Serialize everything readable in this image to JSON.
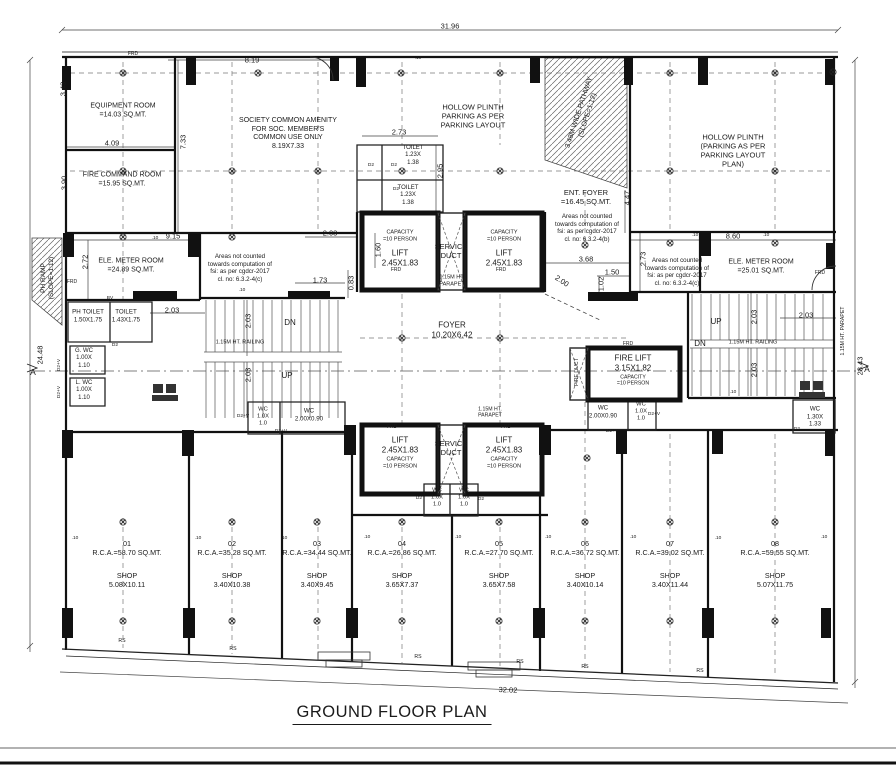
{
  "meta": {
    "ink": "#1a1a1a",
    "paper": "#ffffff"
  },
  "title": {
    "text": "GROUND FLOOR PLAN"
  },
  "annotations": [
    {
      "n": "dim-total-top",
      "t": "31.96",
      "x": 450,
      "y": 26
    },
    {
      "n": "dim-8-19",
      "t": "8.19",
      "x": 252,
      "y": 60
    },
    {
      "n": "dim-3-43",
      "t": "3.43",
      "x": 63,
      "y": 89,
      "r": -90
    },
    {
      "n": "dim-4-09",
      "t": "4.09",
      "x": 112,
      "y": 143
    },
    {
      "n": "dim-7-33",
      "t": "7.33",
      "x": 183,
      "y": 142,
      "r": -90
    },
    {
      "n": "dim-3-90",
      "t": "3.90",
      "x": 64,
      "y": 183,
      "r": -90
    },
    {
      "n": "dim-2-73-toilet",
      "t": "2.73",
      "x": 399,
      "y": 132
    },
    {
      "n": "dim-2-95",
      "t": "2.95",
      "x": 440,
      "y": 171,
      "r": -90
    },
    {
      "n": "dim-9-15",
      "t": "9.15",
      "x": 173,
      "y": 236
    },
    {
      "n": "dim-2-03-top",
      "t": "2.03",
      "x": 330,
      "y": 233
    },
    {
      "n": "dim-8-60",
      "t": "8.60",
      "x": 733,
      "y": 236
    },
    {
      "n": "dim-2-72",
      "t": "2.72",
      "x": 85,
      "y": 262,
      "r": -90
    },
    {
      "n": "dim-2-03-left",
      "t": "2.03",
      "x": 172,
      "y": 310
    },
    {
      "n": "dim-1-60",
      "t": "1.60",
      "x": 378,
      "y": 250,
      "r": -90
    },
    {
      "n": "dim-1-73",
      "t": "1.73",
      "x": 320,
      "y": 280
    },
    {
      "n": "dim-0-83",
      "t": "0.83",
      "x": 351,
      "y": 283,
      "r": -90
    },
    {
      "n": "dim-3-68",
      "t": "3.68",
      "x": 586,
      "y": 259
    },
    {
      "n": "dim-1-50",
      "t": "1.50",
      "x": 612,
      "y": 272
    },
    {
      "n": "dim-1-02",
      "t": "1.02",
      "x": 601,
      "y": 284,
      "r": -90
    },
    {
      "n": "dim-2-00",
      "t": "2.00",
      "x": 562,
      "y": 281,
      "r": 33
    },
    {
      "n": "dim-2-73-right",
      "t": "2.73",
      "x": 643,
      "y": 259,
      "r": -90
    },
    {
      "n": "dim-4-47",
      "t": "4.47",
      "x": 627,
      "y": 198,
      "r": -90
    },
    {
      "n": "dim-2-03-right",
      "t": "2.03",
      "x": 806,
      "y": 315
    },
    {
      "n": "dim-2-03-stair-l1",
      "t": "2.03",
      "x": 248,
      "y": 321,
      "r": -90
    },
    {
      "n": "dim-2-03-stair-l2",
      "t": "2.03",
      "x": 248,
      "y": 375,
      "r": -90
    },
    {
      "n": "dim-2-03-stair-r1",
      "t": "2.03",
      "x": 754,
      "y": 317,
      "r": -90
    },
    {
      "n": "dim-2-03-stair-r2",
      "t": "2.03",
      "x": 754,
      "y": 370,
      "r": -90
    },
    {
      "n": "dim-total-left",
      "t": "24.48",
      "x": 40,
      "y": 355,
      "r": -90
    },
    {
      "n": "dim-total-right",
      "t": "28.43",
      "x": 860,
      "y": 366,
      "r": -90
    },
    {
      "n": "dim-total-bottom",
      "t": "32.02",
      "x": 508,
      "y": 690,
      "r": 2.4
    },
    {
      "n": "room-equipment",
      "t": "EQUIPMENT ROOM\n=14.03 SQ.MT.",
      "x": 123,
      "y": 111,
      "s": 7
    },
    {
      "n": "room-society-amenity",
      "t": "SOCIETY COMMON AMENITY\nFOR SOC. MEMBER'S\nCOMMON USE ONLY\n8.19X7.33",
      "x": 288,
      "y": 134,
      "s": 7
    },
    {
      "n": "room-hollow-plinth-left",
      "t": "HOLLOW PLINTH\nPARKING AS PER\nPARKING LAYOUT",
      "x": 473,
      "y": 116,
      "s": 7.5
    },
    {
      "n": "room-hollow-plinth-right",
      "t": "HOLLOW PLINTH\n(PARKING AS PER\nPARKING LAYOUT\nPLAN)",
      "x": 733,
      "y": 151,
      "s": 7.5
    },
    {
      "n": "room-fire-command",
      "t": "FIRE COMMAND ROOM\n=15.95 SQ.MT.",
      "x": 122,
      "y": 180,
      "s": 7
    },
    {
      "n": "room-toilet-1",
      "t": "TOILET\n1.23X\n1.38",
      "x": 413,
      "y": 156,
      "s": 6
    },
    {
      "n": "room-toilet-2",
      "t": "TOILET\n1.23X\n1.38",
      "x": 408,
      "y": 196,
      "s": 6
    },
    {
      "n": "ramp-pathway",
      "t": "3.48M WIDE PATHWAY\n(SLOPE=1:12)",
      "x": 584,
      "y": 114,
      "s": 7,
      "r": -72
    },
    {
      "n": "room-ent-foyer",
      "t": "ENT. FOYER\n=16.45 SQ.MT.",
      "x": 586,
      "y": 197,
      "s": 7.5
    },
    {
      "n": "note-fsi-b",
      "t": "Areas not counted\ntowards computation of\nfsi: as per cgdcr-2017\ncl. no: 6.3.2-4(b)",
      "x": 587,
      "y": 228,
      "s": 6.2
    },
    {
      "n": "note-fsi-c-left",
      "t": "Areas not counted\ntowards computation of\nfsi: as per cgdcr-2017\ncl. no: 6.3.2-4(c)",
      "x": 240,
      "y": 268,
      "s": 6.2
    },
    {
      "n": "note-fsi-c-right",
      "t": "Areas not counted\ntowards computation of\nfsi: as per cgdcr-2017\ncl. no: 6.3.2-4(c)",
      "x": 677,
      "y": 272,
      "s": 6.2
    },
    {
      "n": "room-ele-meter-left",
      "t": "ELE. METER ROOM\n=24.89 SQ.MT.",
      "x": 131,
      "y": 266,
      "s": 7
    },
    {
      "n": "room-ele-meter-right",
      "t": "ELE. METER ROOM\n=25.01 SQ.MT.",
      "x": 761,
      "y": 267,
      "s": 7
    },
    {
      "n": "ramp-ph",
      "t": "PH RAMP\n(SLOPE=1:12)",
      "x": 48,
      "y": 278,
      "s": 6.5,
      "r": -90
    },
    {
      "n": "lift-ul-capacity",
      "t": "CAPACITY\n=10 PERSON",
      "x": 400,
      "y": 236,
      "s": 5.5
    },
    {
      "n": "lift-ul",
      "t": "LIFT\n2.45X1.83",
      "x": 400,
      "y": 258,
      "s": 8
    },
    {
      "n": "lift-ur-capacity",
      "t": "CAPACITY\n=10 PERSON",
      "x": 504,
      "y": 236,
      "s": 5.5
    },
    {
      "n": "lift-ur",
      "t": "LIFT\n2.45X1.83",
      "x": 504,
      "y": 258,
      "s": 8
    },
    {
      "n": "service-duct-upper",
      "t": "SERVICE\nDUCT",
      "x": 451,
      "y": 251,
      "s": 7.5
    },
    {
      "n": "parapet-upper",
      "t": "1.15M HT.\nPARAPET",
      "x": 452,
      "y": 281,
      "s": 5.5
    },
    {
      "n": "room-foyer",
      "t": "FOYER\n10.20X6.42",
      "x": 452,
      "y": 330,
      "s": 8
    },
    {
      "n": "room-ph-toilet",
      "t": "PH TOILET\n1.50X1.75",
      "x": 88,
      "y": 316,
      "s": 6.2
    },
    {
      "n": "room-toilet-3",
      "t": "TOILET\n1.43X1.75",
      "x": 126,
      "y": 316,
      "s": 6.2
    },
    {
      "n": "room-g-wc",
      "t": "G. WC\n1.00X\n1.10",
      "x": 84,
      "y": 359,
      "s": 6
    },
    {
      "n": "room-l-wc",
      "t": "L. WC\n1.00X\n1.10",
      "x": 84,
      "y": 391,
      "s": 6
    },
    {
      "n": "railing-left",
      "t": "1.15M HT. RAILING",
      "x": 240,
      "y": 343,
      "s": 5.5
    },
    {
      "n": "railing-right",
      "t": "1.15M HT. RAILING",
      "x": 753,
      "y": 343,
      "s": 5.5
    },
    {
      "n": "stair-dn-left",
      "t": "DN",
      "x": 290,
      "y": 323,
      "s": 8
    },
    {
      "n": "stair-up-left",
      "t": "UP",
      "x": 287,
      "y": 376,
      "s": 8
    },
    {
      "n": "stair-up-right",
      "t": "UP",
      "x": 716,
      "y": 322,
      "s": 8
    },
    {
      "n": "stair-dn-right",
      "t": "DN",
      "x": 700,
      "y": 344,
      "s": 8
    },
    {
      "n": "fire-lift",
      "t": "FIRE LIFT\n3.15X1.82",
      "x": 633,
      "y": 363,
      "s": 8
    },
    {
      "n": "fire-lift-capacity",
      "t": "CAPACITY\n=10 PERSON",
      "x": 633,
      "y": 381,
      "s": 5.2
    },
    {
      "n": "fire-duct",
      "t": "FIRE DUCT",
      "x": 577,
      "y": 372,
      "s": 5.2,
      "r": -90
    },
    {
      "n": "wc-left-200",
      "t": "WC\n2.00X0.90",
      "x": 309,
      "y": 415,
      "s": 6.2
    },
    {
      "n": "wc-right-200",
      "t": "WC\n2.00X0.90",
      "x": 603,
      "y": 412,
      "s": 6.2
    },
    {
      "n": "wc-left-10",
      "t": "WC\n1.0X\n1.0",
      "x": 263,
      "y": 417,
      "s": 5.8
    },
    {
      "n": "wc-right-10",
      "t": "WC\n1.0X\n1.0",
      "x": 641,
      "y": 412,
      "s": 5.8
    },
    {
      "n": "wc-lower-10a",
      "t": "WC\n1.0X\n1.0",
      "x": 437,
      "y": 498,
      "s": 5.8
    },
    {
      "n": "wc-lower-10b",
      "t": "WC\n1.0X\n1.0",
      "x": 464,
      "y": 498,
      "s": 5.8
    },
    {
      "n": "wc-130",
      "t": "WC\n1.30X\n1.33",
      "x": 815,
      "y": 417,
      "s": 6.2
    },
    {
      "n": "parapet-right-wall",
      "t": "1.15M HT. PARAPET",
      "x": 843,
      "y": 331,
      "s": 5.2,
      "r": -90
    },
    {
      "n": "parapet-lower",
      "t": "1.15M HT.\nPARAPET",
      "x": 490,
      "y": 413,
      "s": 5.2
    },
    {
      "n": "lift-ll",
      "t": "LIFT\n2.45X1.83",
      "x": 400,
      "y": 445,
      "s": 8
    },
    {
      "n": "lift-ll-capacity",
      "t": "CAPACITY\n=10 PERSON",
      "x": 400,
      "y": 463,
      "s": 5.5
    },
    {
      "n": "lift-lr",
      "t": "LIFT\n2.45X1.83",
      "x": 504,
      "y": 445,
      "s": 8
    },
    {
      "n": "lift-lr-capacity",
      "t": "CAPACITY\n=10 PERSON",
      "x": 504,
      "y": 463,
      "s": 5.5
    },
    {
      "n": "service-duct-lower",
      "t": "SERVICE\nDUCT",
      "x": 451,
      "y": 448,
      "s": 7.5
    },
    {
      "n": "shop-01-rca",
      "t": "01\nR.C.A.=58.70 SQ.MT.",
      "x": 127,
      "y": 549,
      "s": 7.2
    },
    {
      "n": "shop-01",
      "t": "SHOP\n5.08X10.11",
      "x": 127,
      "y": 581,
      "s": 7.2
    },
    {
      "n": "shop-02-rca",
      "t": "02\nR.C.A.=35.28 SQ.MT.",
      "x": 232,
      "y": 549,
      "s": 7.2
    },
    {
      "n": "shop-02",
      "t": "SHOP\n3.40X10.38",
      "x": 232,
      "y": 581,
      "s": 7.2
    },
    {
      "n": "shop-03-rca",
      "t": "03\nR.C.A.=34.44 SQ.MT.",
      "x": 317,
      "y": 549,
      "s": 7.2
    },
    {
      "n": "shop-03",
      "t": "SHOP\n3.40X9.45",
      "x": 317,
      "y": 581,
      "s": 7.2
    },
    {
      "n": "shop-04-rca",
      "t": "04\nR.C.A.=26.86 SQ.MT.",
      "x": 402,
      "y": 549,
      "s": 7.2
    },
    {
      "n": "shop-04",
      "t": "SHOP\n3.65X7.37",
      "x": 402,
      "y": 581,
      "s": 7.2
    },
    {
      "n": "shop-05-rca",
      "t": "05\nR.C.A.=27.70 SQ.MT.",
      "x": 499,
      "y": 549,
      "s": 7.2
    },
    {
      "n": "shop-05",
      "t": "SHOP\n3.65X7.58",
      "x": 499,
      "y": 581,
      "s": 7.2
    },
    {
      "n": "shop-06-rca",
      "t": "06\nR.C.A.=36.72 SQ.MT.",
      "x": 585,
      "y": 549,
      "s": 7.2
    },
    {
      "n": "shop-06",
      "t": "SHOP\n3.40X10.14",
      "x": 585,
      "y": 581,
      "s": 7.2
    },
    {
      "n": "shop-07-rca",
      "t": "07\nR.C.A.=39.02 SQ.MT.",
      "x": 670,
      "y": 549,
      "s": 7.2
    },
    {
      "n": "shop-07",
      "t": "SHOP\n3.40X11.44",
      "x": 670,
      "y": 581,
      "s": 7.2
    },
    {
      "n": "shop-08-rca",
      "t": "08\nR.C.A.=59.55 SQ.MT.",
      "x": 775,
      "y": 549,
      "s": 7.2
    },
    {
      "n": "shop-08",
      "t": "SHOP\n5.07X11.75",
      "x": 775,
      "y": 581,
      "s": 7.2
    },
    {
      "n": "door-frd-1",
      "t": "FRD",
      "x": 133,
      "y": 54,
      "s": 5
    },
    {
      "n": "door-frd-2",
      "t": "FRD",
      "x": 72,
      "y": 282,
      "s": 5
    },
    {
      "n": "door-frd-3",
      "t": "FRD",
      "x": 396,
      "y": 270,
      "s": 5
    },
    {
      "n": "door-frd-4",
      "t": "FRD",
      "x": 501,
      "y": 270,
      "s": 5
    },
    {
      "n": "door-frd-5",
      "t": "FRD",
      "x": 820,
      "y": 273,
      "s": 5
    },
    {
      "n": "door-frd-6",
      "t": "FRD",
      "x": 628,
      "y": 344,
      "s": 5
    },
    {
      "n": "door-frd-7",
      "t": "FRD",
      "x": 392,
      "y": 427,
      "s": 5
    },
    {
      "n": "door-frd-8",
      "t": "FRD",
      "x": 506,
      "y": 427,
      "s": 5
    },
    {
      "n": "valve-bv",
      "t": "BV",
      "x": 110,
      "y": 299,
      "s": 4.8
    },
    {
      "n": "door-d2-1",
      "t": "D2",
      "x": 371,
      "y": 166,
      "s": 4.8
    },
    {
      "n": "door-d2-2",
      "t": "D2",
      "x": 394,
      "y": 166,
      "s": 4.8
    },
    {
      "n": "door-d2-3",
      "t": "D2",
      "x": 396,
      "y": 190,
      "s": 4.8
    },
    {
      "n": "door-d2-4",
      "t": "D2",
      "x": 115,
      "y": 346,
      "s": 4.8
    },
    {
      "n": "door-d2-5",
      "t": "D2",
      "x": 419,
      "y": 499,
      "s": 4.8
    },
    {
      "n": "door-d2-6",
      "t": "D2",
      "x": 481,
      "y": 500,
      "s": 4.8
    },
    {
      "n": "door-d2-7",
      "t": "D2",
      "x": 797,
      "y": 430,
      "s": 4.8
    },
    {
      "n": "door-d2v-1",
      "t": "D2+V",
      "x": 243,
      "y": 417,
      "s": 4.8
    },
    {
      "n": "door-d2v-2",
      "t": "D2+V",
      "x": 281,
      "y": 432,
      "s": 4.8
    },
    {
      "n": "door-d2v-3",
      "t": "D2+V",
      "x": 612,
      "y": 432,
      "s": 4.8
    },
    {
      "n": "door-d2v-4",
      "t": "D2+V",
      "x": 654,
      "y": 415,
      "s": 4.8
    },
    {
      "n": "door-d2v-5",
      "t": "D2+V",
      "x": 60,
      "y": 365,
      "s": 4.8,
      "r": -90
    },
    {
      "n": "door-d2v-6",
      "t": "D2+V",
      "x": 60,
      "y": 392,
      "s": 4.8,
      "r": -90
    },
    {
      "n": "shutter-rs-1",
      "t": "RS",
      "x": 122,
      "y": 641,
      "s": 5.2
    },
    {
      "n": "shutter-rs-2",
      "t": "RS",
      "x": 233,
      "y": 649,
      "s": 5.2
    },
    {
      "n": "shutter-rs-3",
      "t": "RS",
      "x": 418,
      "y": 657,
      "s": 5.2
    },
    {
      "n": "shutter-rs-4",
      "t": "RS",
      "x": 520,
      "y": 662,
      "s": 5.2
    },
    {
      "n": "shutter-rs-5",
      "t": "RS",
      "x": 585,
      "y": 667,
      "s": 5.2
    },
    {
      "n": "shutter-rs-6",
      "t": "RS",
      "x": 700,
      "y": 671,
      "s": 5.2
    },
    {
      "n": "dim-010-1",
      "t": ".10",
      "x": 418,
      "y": 59,
      "s": 4.8
    },
    {
      "n": "dim-010-2",
      "t": ".10",
      "x": 155,
      "y": 239,
      "s": 4.8
    },
    {
      "n": "dim-010-3",
      "t": ".10",
      "x": 695,
      "y": 236,
      "s": 4.8
    },
    {
      "n": "dim-010-4",
      "t": ".10",
      "x": 766,
      "y": 236,
      "s": 4.8
    },
    {
      "n": "dim-010-5",
      "t": ".10",
      "x": 242,
      "y": 291,
      "s": 4.8
    },
    {
      "n": "dim-010-6",
      "t": ".10",
      "x": 733,
      "y": 393,
      "s": 4.8
    },
    {
      "n": "dim-010-7",
      "t": ".10",
      "x": 75,
      "y": 539,
      "s": 4.8
    },
    {
      "n": "dim-010-8",
      "t": ".10",
      "x": 198,
      "y": 539,
      "s": 4.8
    },
    {
      "n": "dim-010-9",
      "t": ".10",
      "x": 284,
      "y": 539,
      "s": 4.8
    },
    {
      "n": "dim-010-10",
      "t": ".10",
      "x": 367,
      "y": 538,
      "s": 4.8
    },
    {
      "n": "dim-010-11",
      "t": ".10",
      "x": 458,
      "y": 538,
      "s": 4.8
    },
    {
      "n": "dim-010-12",
      "t": ".10",
      "x": 548,
      "y": 538,
      "s": 4.8
    },
    {
      "n": "dim-010-13",
      "t": ".10",
      "x": 633,
      "y": 538,
      "s": 4.8
    },
    {
      "n": "dim-010-14",
      "t": ".10",
      "x": 718,
      "y": 539,
      "s": 4.8
    },
    {
      "n": "dim-010-15",
      "t": ".10",
      "x": 824,
      "y": 538,
      "s": 4.8
    },
    {
      "n": "section-marker-a-left",
      "t": "A",
      "x": 33,
      "y": 372,
      "s": 8.5
    },
    {
      "n": "section-marker-a-right",
      "t": "867A",
      "x": 0,
      "y": 0,
      "s": 0
    }
  ],
  "section_marker_right": {
    "t": "A",
    "x": 867,
    "y": 369,
    "s": 8.5
  }
}
